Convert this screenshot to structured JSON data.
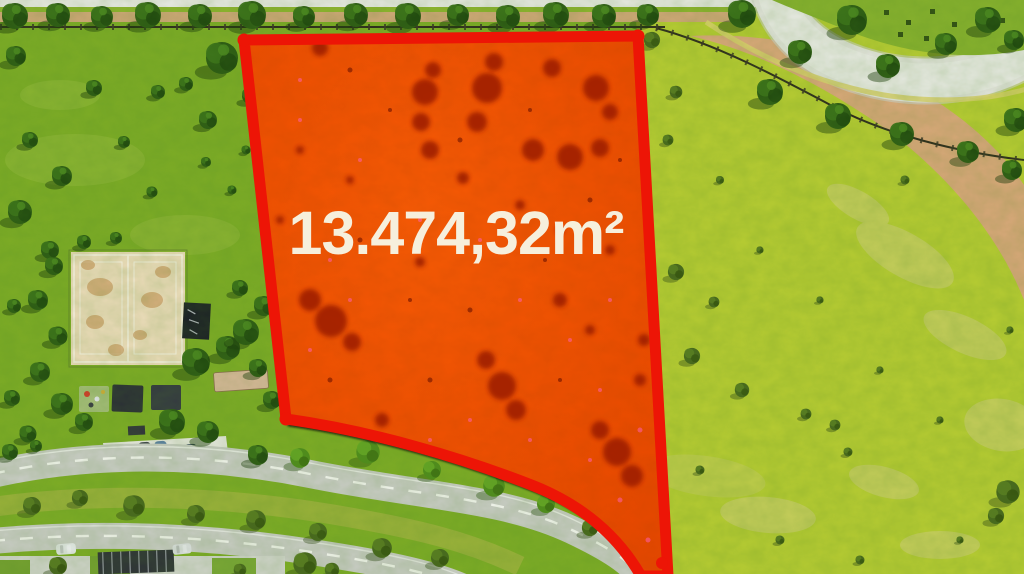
{
  "overlay": {
    "area_label": "13.474,32m²"
  },
  "colors": {
    "plot_border": "#ed1506",
    "plot_fill": "#f85b06",
    "label_text": "#f6efdc",
    "grass_left": "#7dac26",
    "grass_right": "#b7cc33",
    "road_surface": "#c9ccc5",
    "sand_court": "#ecdcba",
    "bare_earth": "#d9a87a",
    "tree_dark": "#2c5a14",
    "shadow": "#0a0a08"
  }
}
